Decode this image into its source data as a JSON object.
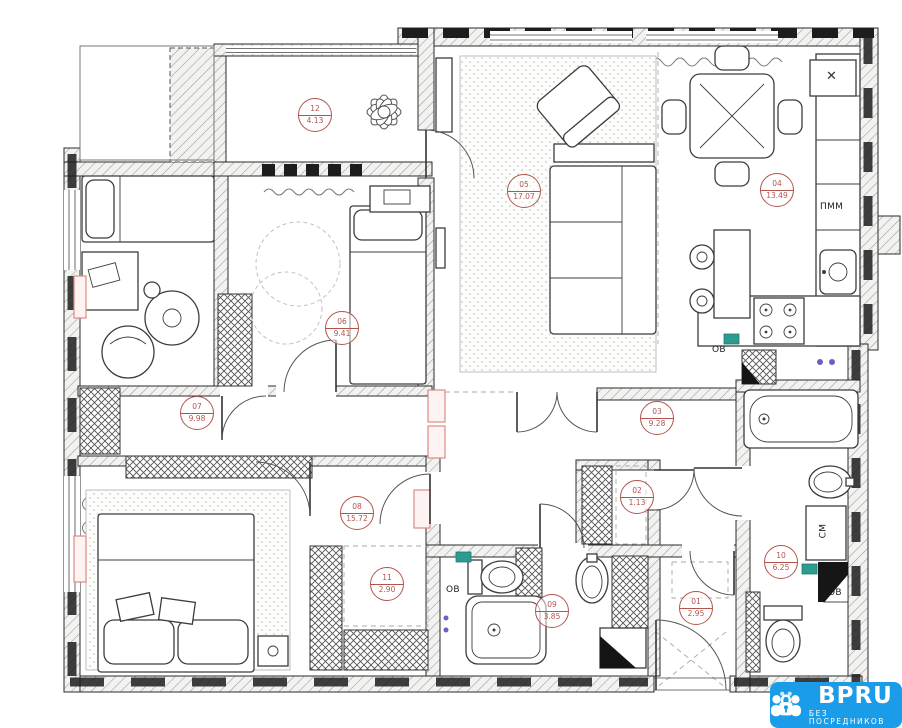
{
  "rooms": [
    {
      "number": "01",
      "area": "2.95"
    },
    {
      "number": "02",
      "area": "1.13"
    },
    {
      "number": "03",
      "area": "9.28"
    },
    {
      "number": "04",
      "area": "13.49"
    },
    {
      "number": "05",
      "area": "17.07"
    },
    {
      "number": "06",
      "area": "9.41"
    },
    {
      "number": "07",
      "area": "9.98"
    },
    {
      "number": "08",
      "area": "15.72"
    },
    {
      "number": "09",
      "area": "3.85"
    },
    {
      "number": "10",
      "area": "6.25"
    },
    {
      "number": "11",
      "area": "2.90"
    },
    {
      "number": "12",
      "area": "4.13"
    }
  ],
  "labels": {
    "dishwasher": "ПММ",
    "washing_machine": "СМ",
    "vent_kitchen": "ОВ",
    "vent_bath_small": "ОВ",
    "vent_bath_big": "ОВ",
    "close": "✕"
  },
  "logo": {
    "brand": "BPRU",
    "tagline": "БЕЗ ПОСРЕДНИКОВ"
  },
  "colors": {
    "logo_blue": "#1B9CE8",
    "marker_red": "#B2544C",
    "radiator_pink": "#DD8B80",
    "vent_teal": "#2E9B8F"
  }
}
